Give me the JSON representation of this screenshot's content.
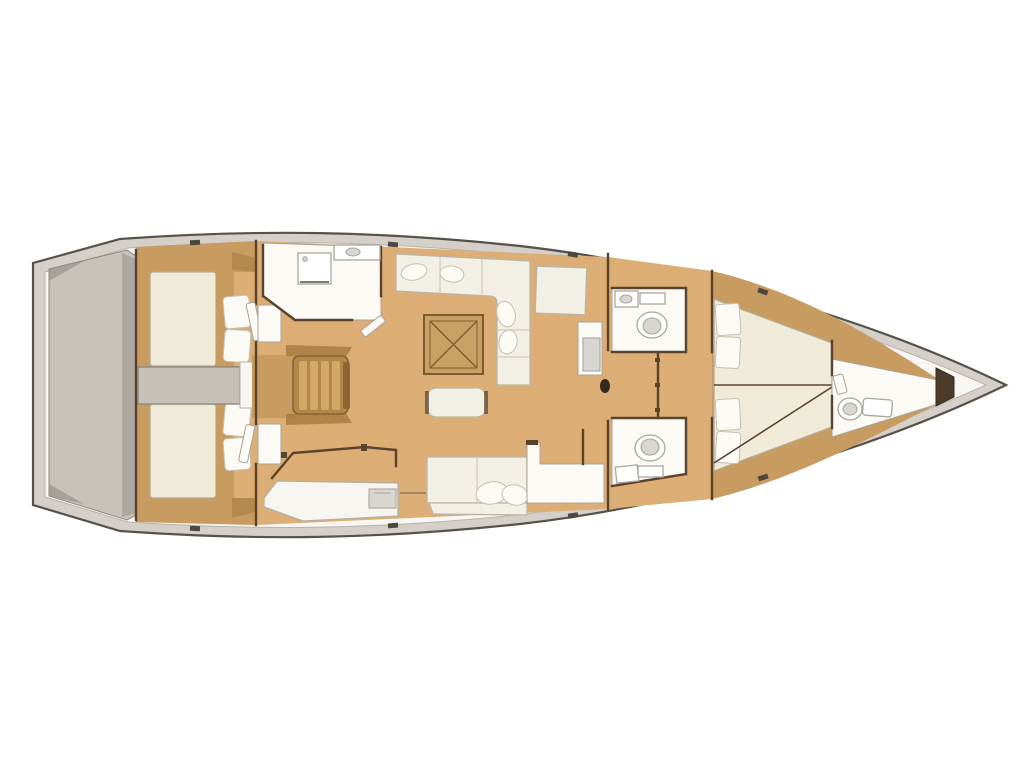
{
  "plan": {
    "label": "sailboat-interior-floor-plan-top-view",
    "orientation": "bow-right-stern-left"
  },
  "colors": {
    "background": "#ffffff",
    "hull_outline": "#56524a",
    "hull_rim": "#d4cfc8",
    "deck_white": "#f7f6f2",
    "platform": "#c8c1ba",
    "platform_shade": "#99918a",
    "wood_floor": "#dcae75",
    "wood_trim": "#c89b60",
    "wood_dark": "#a87c42",
    "wall_brown": "#5a432c",
    "bed_cream": "#f0ead9",
    "bed_border": "#b6ab94",
    "pillow_white": "#fbfaf5",
    "pillow_border": "#c6c0b1",
    "sofa_white": "#f2efe5",
    "sofa_border": "#bab4a5",
    "fixture_gray": "#d7d6d1",
    "fixture_border": "#a9a79e",
    "engine_gray": "#c6c0b8",
    "engine_border": "#908a80",
    "table_wood": "#c9a064",
    "table_line": "#7d5a31",
    "stairs_wood": "#d3a765",
    "stairs_base": "#b3874a",
    "stairs_dark": "#8a6230",
    "locker_dark": "#4d3b29"
  },
  "regions": [
    "swim-platform",
    "aft-cabin-port",
    "aft-cabin-starboard",
    "engine-compartment",
    "companionway-stairs",
    "aft-head",
    "galley",
    "salon-settee",
    "salon-table",
    "salon-bench",
    "nav-station",
    "starboard-settee",
    "mid-head-port",
    "mid-head-starboard",
    "corridor",
    "forward-cabin",
    "bow-head",
    "anchor-locker"
  ]
}
